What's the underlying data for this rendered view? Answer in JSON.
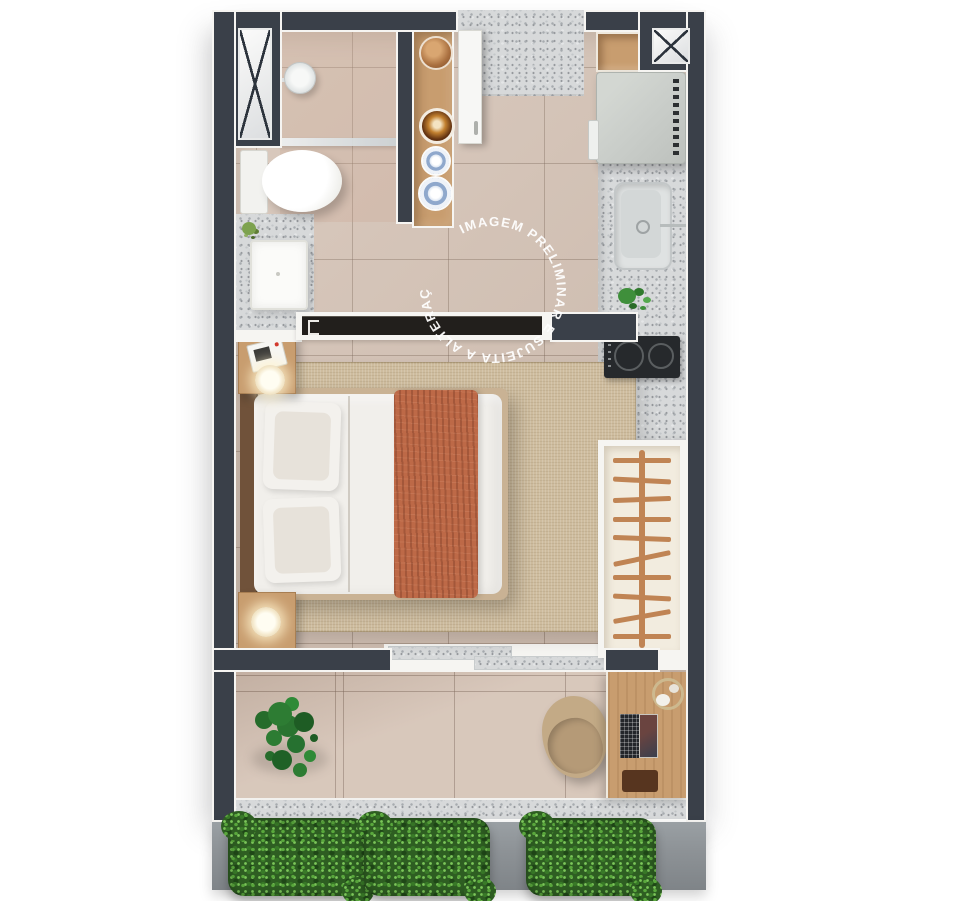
{
  "watermark": {
    "text": "IMAGEM PRELIMINAR E SUJEITA A ALTERAÇÕES.",
    "color": "#ffffff"
  },
  "palette": {
    "background": "#ffffff",
    "wall": "#3a4049",
    "wall_outline": "#f6f5f2",
    "floor": "#d3c0b2",
    "grout": "#9c8b7d",
    "terrazzo": "#d7d9da",
    "terrazzo_speck": "#a7abaf",
    "rug": "#cebc9e",
    "wood": "#c89d6f",
    "wood_dark": "#70523a",
    "bedding": "#f1efeb",
    "pillow": "#e7e2da",
    "throw": "#bd6947",
    "appliance": "#c9cdc9",
    "cooktop": "#26292c",
    "closet": "#f2ecdf",
    "hanger": "#c08454",
    "ledge": "#8e9397",
    "hedge": "#3c7c2e",
    "plant": "#2d7c33",
    "chair": "#c3aa86",
    "glass": "#e9edee"
  },
  "fixtures": {
    "shaft_count": 2,
    "closet_hanger_count": 10,
    "cooktop_burner_count": 2,
    "shelf_items": [
      "wood-bowl",
      "amber-bowl",
      "ceramic-plate",
      "ceramic-plate"
    ],
    "planter_count": 3
  }
}
